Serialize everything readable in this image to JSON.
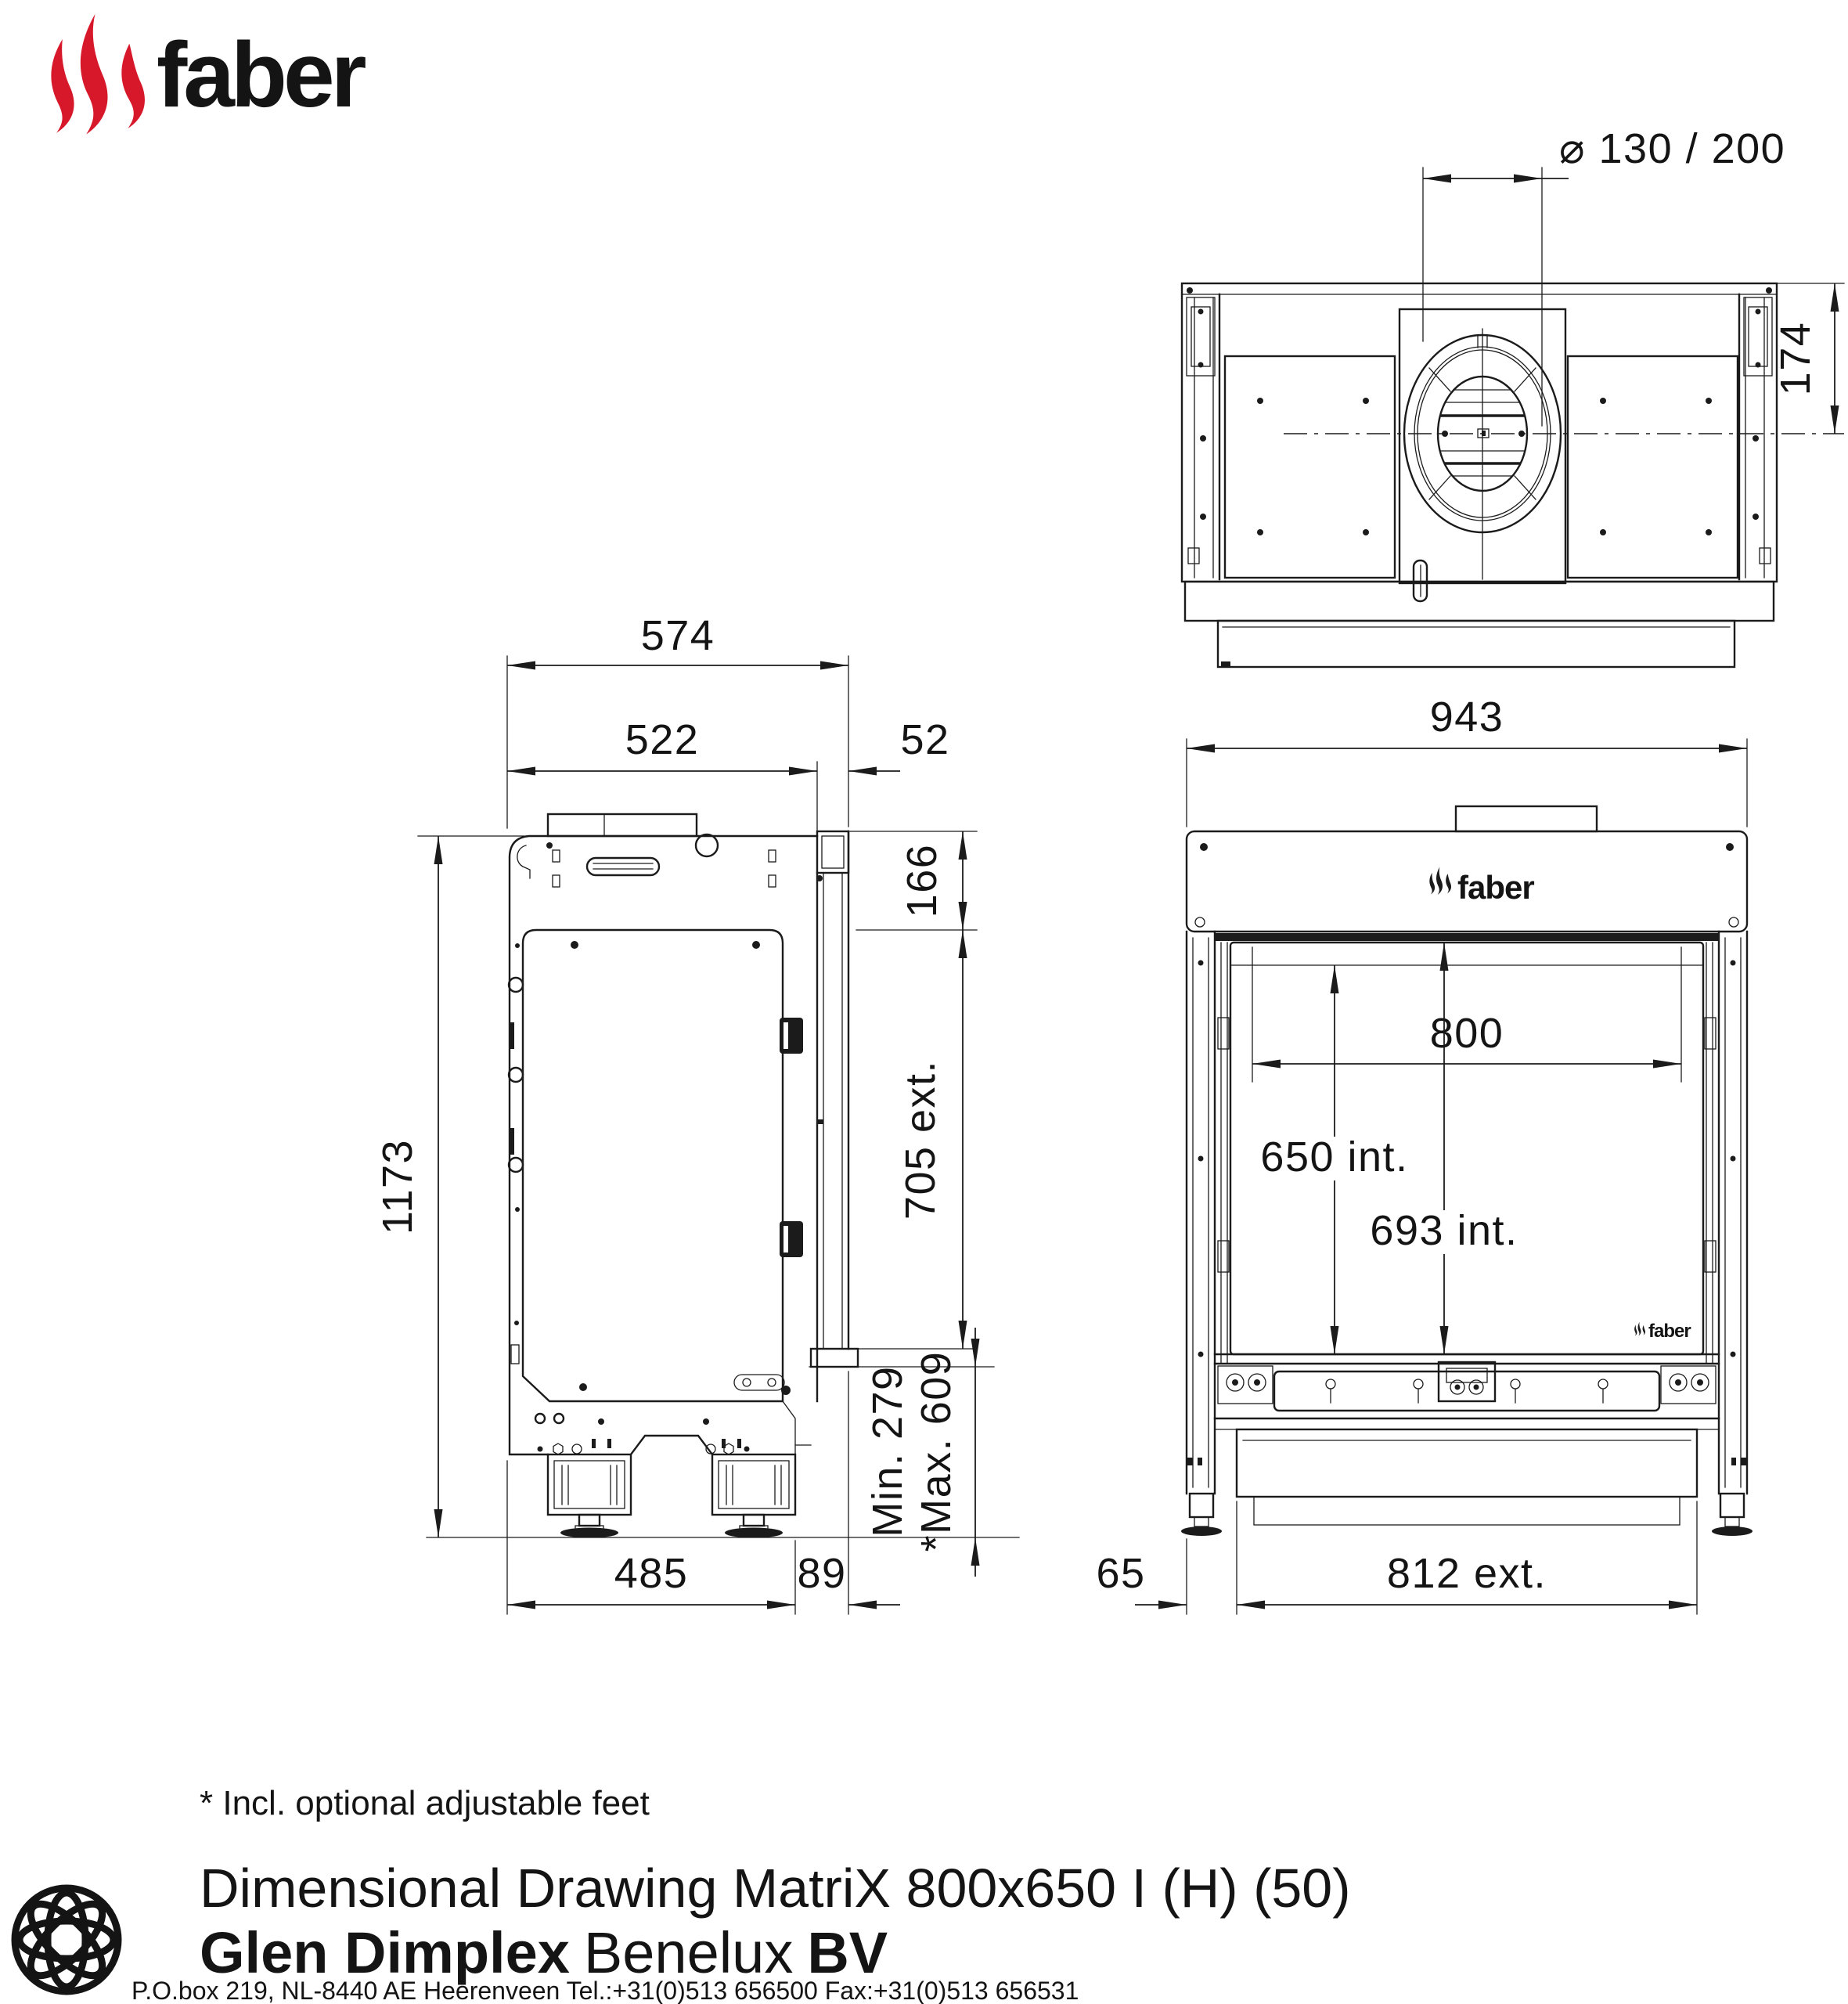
{
  "brand": {
    "name": "faber",
    "flame_color": "#d7182a",
    "line_color": "#1b1b1b"
  },
  "top_view": {
    "flue_dim": "⌀ 130 / 200",
    "depth_to_center": "174"
  },
  "side_view": {
    "total_depth": "574",
    "body_depth": "522",
    "frame_depth": "52",
    "frame_top_height": "166",
    "ext_depth": "705 ext.",
    "total_height": "1173",
    "min_height": "Min. 279",
    "max_height": "*Max. 609",
    "base_depth": "485",
    "base_to_frame": "89"
  },
  "front_view": {
    "total_width": "943",
    "opening_width": "800",
    "int_height_glass": "650 int.",
    "int_height_frame": "693 int.",
    "side_offset": "65",
    "ext_width": "812 ext."
  },
  "footer": {
    "note": "* Incl. optional adjustable feet",
    "title": "Dimensional Drawing MatriX 800x650 I (H) (50)",
    "company_bold": "Glen Dimplex",
    "company_regular": "Benelux",
    "company_suffix": "BV",
    "address": "P.O.box 219, NL-8440 AE Heerenveen Tel.:+31(0)513 656500  Fax:+31(0)513 656531"
  }
}
